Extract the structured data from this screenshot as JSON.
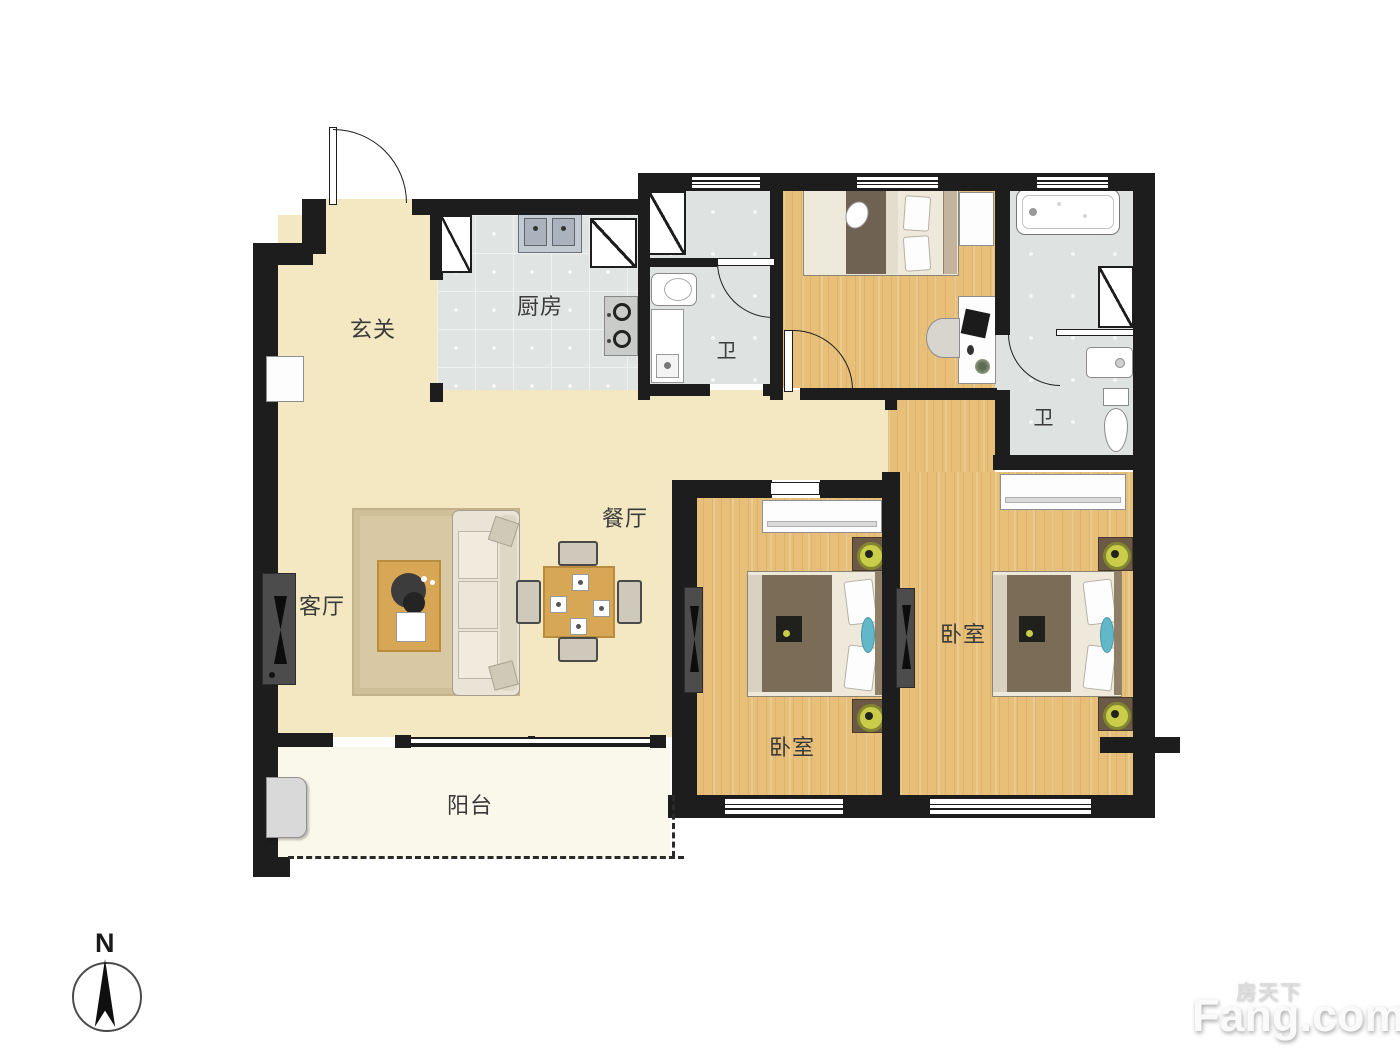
{
  "plan": {
    "rooms": {
      "foyer": "玄关",
      "kitchen": "厨房",
      "bath_a": "卫",
      "bath_b": "卫",
      "living": "客厅",
      "dining": "餐厅",
      "bedroom_a": "卧室",
      "bedroom_b": "卧室",
      "balcony": "阳台"
    },
    "compass": {
      "north": "N"
    },
    "watermark": {
      "brand_cn": "房天下",
      "brand_en": "Fang.com"
    },
    "colors": {
      "wall": "#1d1d1d",
      "floor_main": "#f3e8c2",
      "floor_wood": "#e7bf78",
      "floor_tile": "#e0e4e3",
      "floor_balcony": "#faf7eb",
      "lamp": "#c9cd49",
      "accent_teal": "#62b7c8"
    }
  }
}
